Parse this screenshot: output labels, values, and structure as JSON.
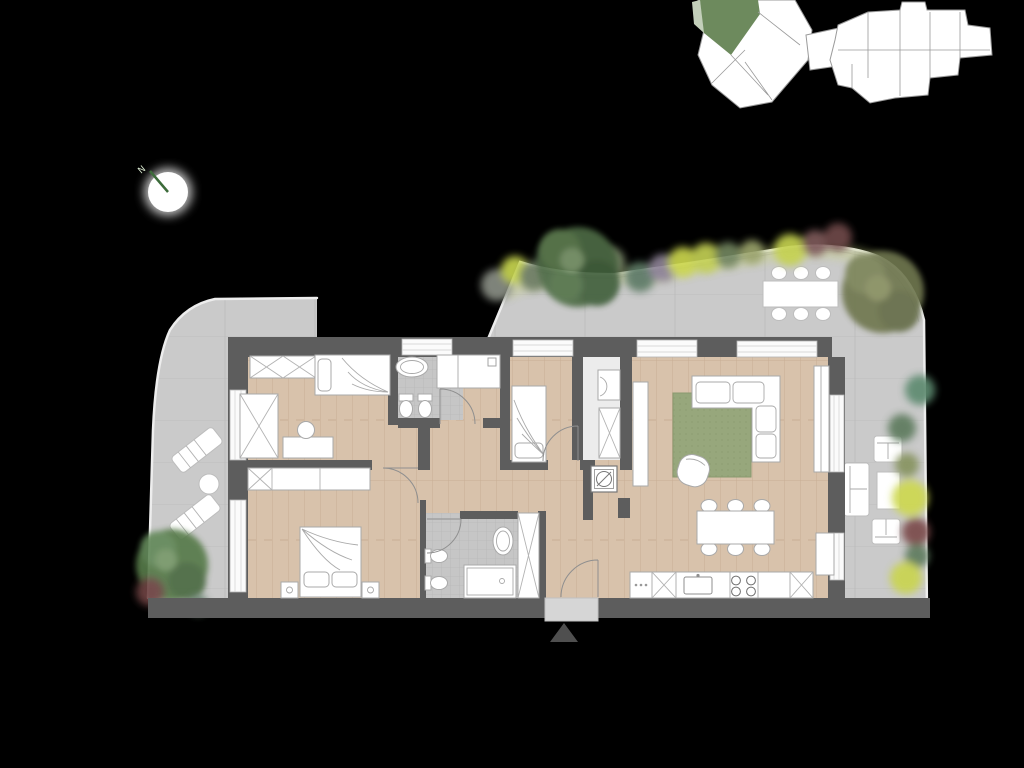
{
  "compass": {
    "label": "N"
  },
  "palette": {
    "background": "#000000",
    "wall": "#5d5d5d",
    "wood_floor": "#d8c2ab",
    "wood_plank_line": "#c8ae94",
    "terrace": "#cacaca",
    "terrace_joint": "#bdbdbd",
    "tile": "#c6c6c6",
    "rug": "#97a77c",
    "furniture": "#ffffff",
    "site_plan_unit": "#6d8a5d",
    "tree_dark_green": "#4d6b45",
    "tree_olive": "#70774f",
    "bush_yellow": "#cdd84f",
    "bush_maroon": "#6f4848",
    "bush_teal": "#5d7a66",
    "entrance_marker": "#4f4f4f",
    "compass_needle": "#3c6b3a"
  }
}
